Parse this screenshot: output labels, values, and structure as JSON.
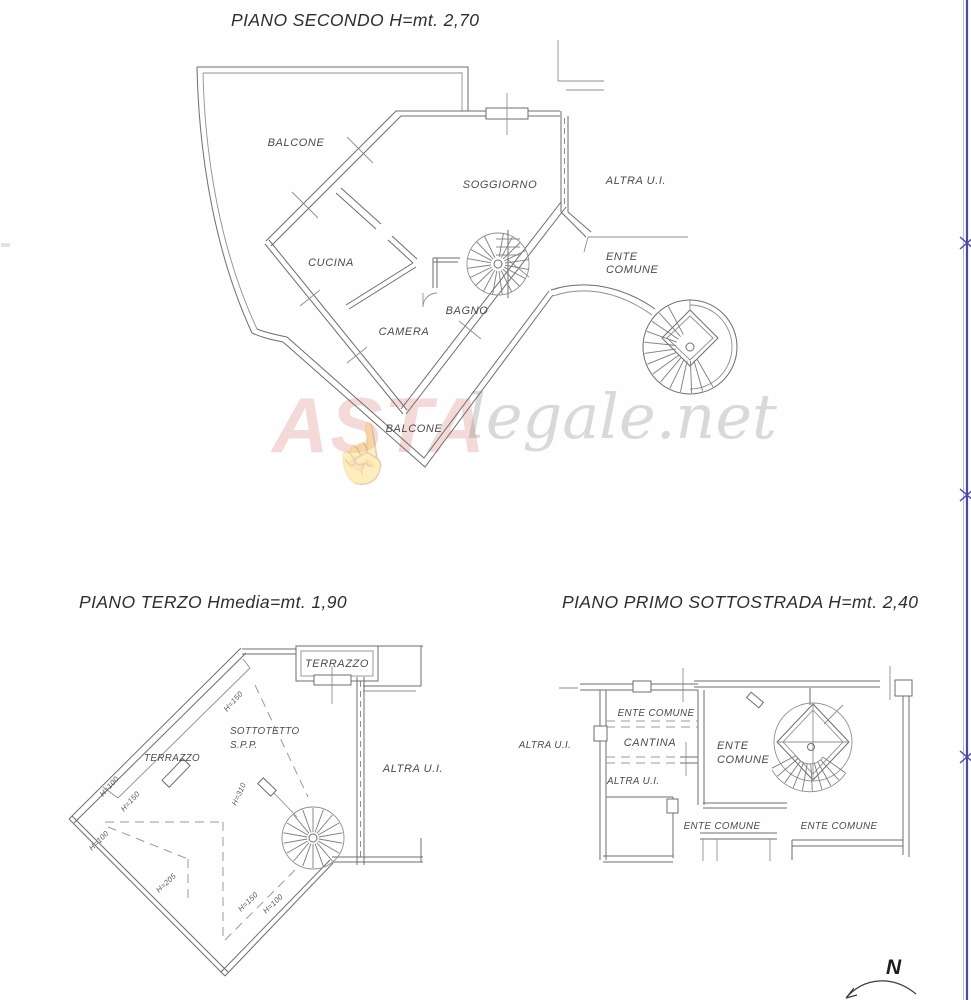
{
  "page": {
    "watermark": {
      "brand_bold": "ASTA",
      "brand_rest": "legale.net"
    },
    "north_label": "N"
  },
  "plan_secondo": {
    "title": "PIANO SECONDO H=mt. 2,70",
    "labels": {
      "balcone_top": "BALCONE",
      "soggiorno": "SOGGIORNO",
      "altra_ui": "ALTRA U.I.",
      "cucina": "CUCINA",
      "ente": "ENTE",
      "comune": "COMUNE",
      "camera": "CAMERA",
      "bagno": "BAGNO",
      "balcone_bottom": "BALCONE"
    }
  },
  "plan_terzo": {
    "title": "PIANO TERZO Hmedia=mt. 1,90",
    "labels": {
      "terrazzo_top": "TERRAZZO",
      "sottotetto": "SOTTOTETTO",
      "spp": "S.P.P.",
      "terrazzo_left": "TERRAZZO",
      "altra_ui": "ALTRA U.I."
    },
    "heights": {
      "h150_top": "H=150",
      "h100_left": "H=100",
      "h150_left": "H=150",
      "h310": "H=310",
      "h100_mid": "H=100",
      "h205": "H=205",
      "h150_bottom": "H=150",
      "h100_bottom": "H=100"
    }
  },
  "plan_primo": {
    "title": "PIANO PRIMO SOTTOSTRADA H=mt. 2,40",
    "labels": {
      "ente_comune_top": "ENTE COMUNE",
      "cantina": "CANTINA",
      "altra_ui_outside": "ALTRA U.I.",
      "altra_ui_inner": "ALTRA U.I.",
      "ente": "ENTE",
      "comune": "COMUNE",
      "ente_comune_bottom_left": "ENTE COMUNE",
      "ente_comune_bottom_right": "ENTE COMUNE"
    }
  }
}
